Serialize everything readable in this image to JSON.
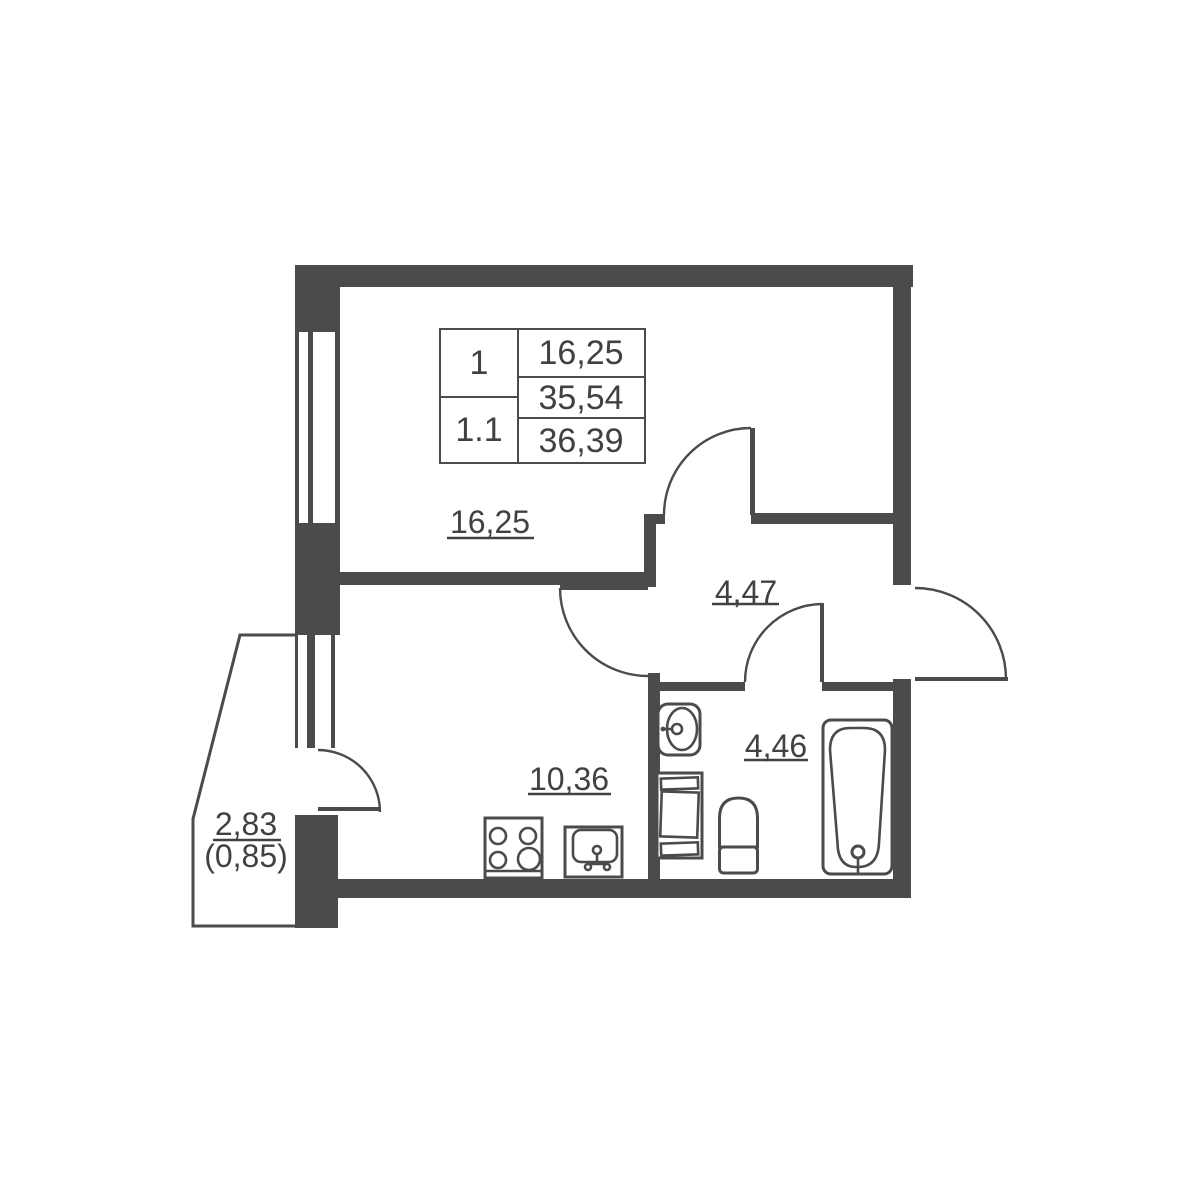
{
  "colors": {
    "wall": "#4b4b4b",
    "line": "#4b4b4b",
    "text": "#414141",
    "background": "#ffffff"
  },
  "legend": {
    "unit_labels": [
      "1",
      "1.1"
    ],
    "area_values": [
      "16,25",
      "35,54",
      "36,39"
    ]
  },
  "rooms": {
    "living_room": {
      "area": "16,25"
    },
    "hallway": {
      "area": "4,47"
    },
    "kitchen": {
      "area": "10,36"
    },
    "bathroom": {
      "area": "4,46"
    },
    "balcony": {
      "area": "2,83",
      "area_reduced": "(0,85)"
    }
  },
  "fixtures": {
    "bathtub": "bathtub",
    "toilet": "toilet",
    "wash_basin": "wash-basin",
    "washing_machine": "washing-machine",
    "stove": "stove",
    "kitchen_sink": "kitchen-sink"
  }
}
